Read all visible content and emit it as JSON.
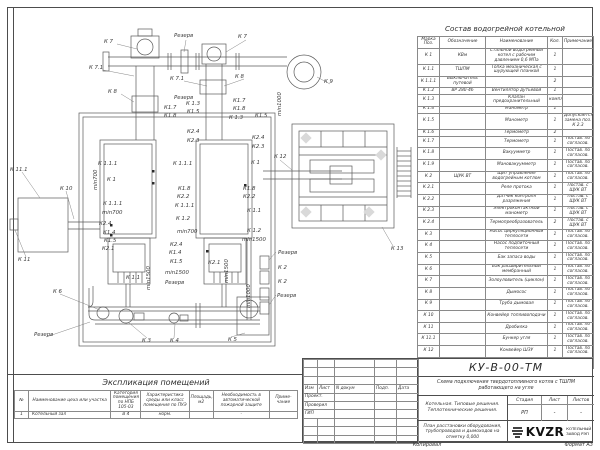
{
  "colors": {
    "line": "#555555",
    "text": "#333333",
    "paper": "#ffffff",
    "diamond_fill": "#d9d9d9"
  },
  "composition_table": {
    "title": "Состав водогрейной котельной",
    "headers": [
      "Марка Поз.",
      "Обозначение",
      "Наименование",
      "Кол.",
      "Примечание"
    ],
    "rows": [
      {
        "pos": "К 1",
        "code": "КВм",
        "name": "Стальной водогрейный котел с рабочим давлением 0,6 МПа",
        "qty": "1",
        "note": ""
      },
      {
        "pos": "К 1.1",
        "code": "ТШПМ",
        "name": "Топка механическая с шурующей планкой",
        "qty": "1",
        "note": ""
      },
      {
        "pos": "К 1.1.1",
        "code": "Выключатель путевой",
        "name": "",
        "qty": "2",
        "note": ""
      },
      {
        "pos": "К 1.2",
        "code": "ВР 280-46",
        "name": "Вентилятор дутьевой",
        "qty": "1",
        "note": ""
      },
      {
        "pos": "К 1.3",
        "code": "",
        "name": "Клапан предохранительный",
        "qty": "компл",
        "note": ""
      },
      {
        "pos": "К 1.4",
        "code": "",
        "name": "Манометр",
        "qty": "1",
        "note": ""
      },
      {
        "pos": "К 1.5",
        "code": "",
        "name": "Манометр",
        "qty": "1",
        "note": "Допускается замена поз. К 2.3"
      },
      {
        "pos": "К 1.6",
        "code": "",
        "name": "Термометр",
        "qty": "2",
        "note": ""
      },
      {
        "pos": "К 1.7",
        "code": "",
        "name": "Термометр",
        "qty": "1",
        "note": "Постав. по согласов."
      },
      {
        "pos": "К 1.8",
        "code": "",
        "name": "Вакуумметр",
        "qty": "1",
        "note": "Постав. по согласов."
      },
      {
        "pos": "К 1.9",
        "code": "",
        "name": "Мановакуумметр",
        "qty": "1",
        "note": "Постав. по согласов."
      },
      {
        "pos": "К 2",
        "code": "ЩУК ВТ",
        "name": "Щит управления водогрейным котлом",
        "qty": "1",
        "note": "Постав. по согласов."
      },
      {
        "pos": "К 2.1",
        "code": "",
        "name": "Реле протока",
        "qty": "1",
        "note": "Постав. с ЩУК ВТ"
      },
      {
        "pos": "К 2.2",
        "code": "",
        "name": "Датчик контроля разряжения",
        "qty": "1",
        "note": "Постав. с ЩУК ВТ"
      },
      {
        "pos": "К 2.3",
        "code": "",
        "name": "Электроконтактный манометр",
        "qty": "1",
        "note": "Постав. с ЩУК ВТ"
      },
      {
        "pos": "К 2.4",
        "code": "",
        "name": "Термопреобразователь",
        "qty": "2",
        "note": "Постав. с ЩУК ВТ"
      },
      {
        "pos": "К 3",
        "code": "",
        "name": "Насос циркуляционный теплосети",
        "qty": "1",
        "note": "Постав. по согласов."
      },
      {
        "pos": "К 4",
        "code": "",
        "name": "Насос подпиточный теплосети",
        "qty": "1",
        "note": "Постав. по согласов."
      },
      {
        "pos": "К 5",
        "code": "",
        "name": "Бак запаса воды",
        "qty": "1",
        "note": "Постав. по согласов."
      },
      {
        "pos": "К 6",
        "code": "",
        "name": "Бак расширительный мембранный",
        "qty": "1",
        "note": "Постав. по согласов."
      },
      {
        "pos": "К 7",
        "code": "",
        "name": "Золоуловитель (циклон)",
        "qty": "1",
        "note": "Постав. по согласов."
      },
      {
        "pos": "К 8",
        "code": "",
        "name": "Дымосос",
        "qty": "1",
        "note": "Постав. по согласов."
      },
      {
        "pos": "К 9",
        "code": "",
        "name": "Труба дымовая",
        "qty": "1",
        "note": "Постав. по согласов."
      },
      {
        "pos": "К 10",
        "code": "",
        "name": "Конвейер топливоподачи",
        "qty": "1",
        "note": "Постав. по согласов."
      },
      {
        "pos": "К 11",
        "code": "",
        "name": "Дробилка",
        "qty": "1",
        "note": "Постав. по согласов."
      },
      {
        "pos": "К 11.1",
        "code": "",
        "name": "Бункер угля",
        "qty": "1",
        "note": "Постав. по согласов."
      },
      {
        "pos": "К 12",
        "code": "",
        "name": "Конвейер ШЗУ",
        "qty": "1",
        "note": "Постав. по согласов."
      },
      {
        "pos": "К 13",
        "code": "",
        "name": "Бункер шлакоприемник",
        "qty": "1",
        "note": "Постав. по согласов."
      }
    ]
  },
  "room_schedule": {
    "title": "Экспликация помещений",
    "headers": [
      "№",
      "Наименование цеха или участка",
      "Категория помещения по НПБ 105-03",
      "Характеристика среды или класс помещения по ПУЭ",
      "Площадь, м2",
      "Необходимость в автоматической пожарной защите",
      "Приме- чание"
    ],
    "rows": [
      [
        "1",
        "Котельный зал",
        "В 4",
        "норм.",
        "",
        "-",
        ""
      ]
    ]
  },
  "title_block": {
    "doc_number": "КУ-В-00-ТМ",
    "scheme_title": "Схема подключения твердотопливного котла с ТШПМ работающего на угле",
    "project_title": "Котельная. Типовые решения. Теплотехнические решения.",
    "sheet_title": "План расстановки оборудования, трубопроводов и дымоходов на отметку 0,000",
    "stage_label": "Стадия",
    "sheet_label": "Лист",
    "sheets_label": "Листов",
    "stage": "РП",
    "sheet": "-",
    "sheets": "-",
    "sig_headers": [
      "Изм",
      "Лист",
      "N докум",
      "Подп.",
      "Дата"
    ],
    "roles": [
      "Проект.",
      "Проверил",
      "ГИП"
    ],
    "logo": {
      "text": "KVZR",
      "line1": "КОТЕЛЬНЫЙ",
      "line2": "ЗАВОД РЭП"
    }
  },
  "footer": {
    "copied_label": "Копировал",
    "format_label": "Формат А3"
  },
  "drawing": {
    "labels": [
      {
        "t": "К 7",
        "x": 104,
        "y": 43
      },
      {
        "t": "Резерв",
        "x": 174,
        "y": 37
      },
      {
        "t": "К 7",
        "x": 238,
        "y": 38
      },
      {
        "t": "К 7.1",
        "x": 89,
        "y": 69
      },
      {
        "t": "К 7.1",
        "x": 170,
        "y": 80
      },
      {
        "t": "К 8",
        "x": 108,
        "y": 93
      },
      {
        "t": "Резерв",
        "x": 174,
        "y": 99
      },
      {
        "t": "К 8",
        "x": 235,
        "y": 78
      },
      {
        "t": "К 9",
        "x": 324,
        "y": 83
      },
      {
        "t": "min1000",
        "x": 281,
        "y": 116,
        "r": -90
      },
      {
        "t": "К1.7",
        "x": 164,
        "y": 109
      },
      {
        "t": "К1.8",
        "x": 164,
        "y": 117
      },
      {
        "t": "К 1.3",
        "x": 186,
        "y": 105
      },
      {
        "t": "К1.5",
        "x": 187,
        "y": 113
      },
      {
        "t": "К1.7",
        "x": 233,
        "y": 102
      },
      {
        "t": "К1.8",
        "x": 233,
        "y": 110
      },
      {
        "t": "К 1.3",
        "x": 229,
        "y": 119
      },
      {
        "t": "К1.5",
        "x": 255,
        "y": 117
      },
      {
        "t": "К2.4",
        "x": 187,
        "y": 133
      },
      {
        "t": "К2.3",
        "x": 187,
        "y": 142
      },
      {
        "t": "К2.4",
        "x": 252,
        "y": 139
      },
      {
        "t": "К2.3",
        "x": 252,
        "y": 148
      },
      {
        "t": "К 12",
        "x": 274,
        "y": 158
      },
      {
        "t": "К 1.1.1",
        "x": 98,
        "y": 165
      },
      {
        "t": "min700",
        "x": 97,
        "y": 190,
        "r": -90
      },
      {
        "t": "К 1",
        "x": 107,
        "y": 181
      },
      {
        "t": "К 1.1.1",
        "x": 103,
        "y": 205
      },
      {
        "t": "min700",
        "x": 102,
        "y": 214
      },
      {
        "t": "К2.4",
        "x": 99,
        "y": 225
      },
      {
        "t": "К1.4",
        "x": 103,
        "y": 234
      },
      {
        "t": "К1.5",
        "x": 104,
        "y": 242
      },
      {
        "t": "К2.1",
        "x": 102,
        "y": 250
      },
      {
        "t": "К 1.1",
        "x": 126,
        "y": 279
      },
      {
        "t": "min1500",
        "x": 150,
        "y": 290,
        "r": -90
      },
      {
        "t": "К 1.1.1",
        "x": 173,
        "y": 165
      },
      {
        "t": "К1.8",
        "x": 178,
        "y": 190
      },
      {
        "t": "К2.2",
        "x": 177,
        "y": 198
      },
      {
        "t": "К 1.1.1",
        "x": 175,
        "y": 207
      },
      {
        "t": "К 1.2",
        "x": 176,
        "y": 220
      },
      {
        "t": "min700",
        "x": 177,
        "y": 233
      },
      {
        "t": "К2.4",
        "x": 170,
        "y": 246
      },
      {
        "t": "К1.4",
        "x": 169,
        "y": 254
      },
      {
        "t": "К1.5",
        "x": 170,
        "y": 263
      },
      {
        "t": "min1500",
        "x": 165,
        "y": 274
      },
      {
        "t": "Резерв",
        "x": 165,
        "y": 284
      },
      {
        "t": "К2.1",
        "x": 208,
        "y": 264
      },
      {
        "t": "min1500",
        "x": 228,
        "y": 283,
        "r": -90
      },
      {
        "t": "К 1",
        "x": 251,
        "y": 164
      },
      {
        "t": "К1.8",
        "x": 243,
        "y": 190
      },
      {
        "t": "К2.2",
        "x": 243,
        "y": 198
      },
      {
        "t": "К 1.1",
        "x": 247,
        "y": 212
      },
      {
        "t": "К 1.2",
        "x": 247,
        "y": 232
      },
      {
        "t": "min1500",
        "x": 242,
        "y": 241
      },
      {
        "t": "min1000",
        "x": 250,
        "y": 308,
        "r": -90
      },
      {
        "t": "Резерв",
        "x": 278,
        "y": 254
      },
      {
        "t": "К 2",
        "x": 278,
        "y": 269
      },
      {
        "t": "К 2",
        "x": 278,
        "y": 283
      },
      {
        "t": "Резерв",
        "x": 277,
        "y": 297
      },
      {
        "t": "К 11.1",
        "x": 10,
        "y": 171
      },
      {
        "t": "К 10",
        "x": 60,
        "y": 190
      },
      {
        "t": "К 11",
        "x": 18,
        "y": 261
      },
      {
        "t": "К 6",
        "x": 53,
        "y": 293
      },
      {
        "t": "Резерв",
        "x": 34,
        "y": 336
      },
      {
        "t": "К 3",
        "x": 142,
        "y": 342
      },
      {
        "t": "К 4",
        "x": 170,
        "y": 342
      },
      {
        "t": "К 5",
        "x": 228,
        "y": 341
      },
      {
        "t": "К 13",
        "x": 391,
        "y": 250
      }
    ]
  }
}
